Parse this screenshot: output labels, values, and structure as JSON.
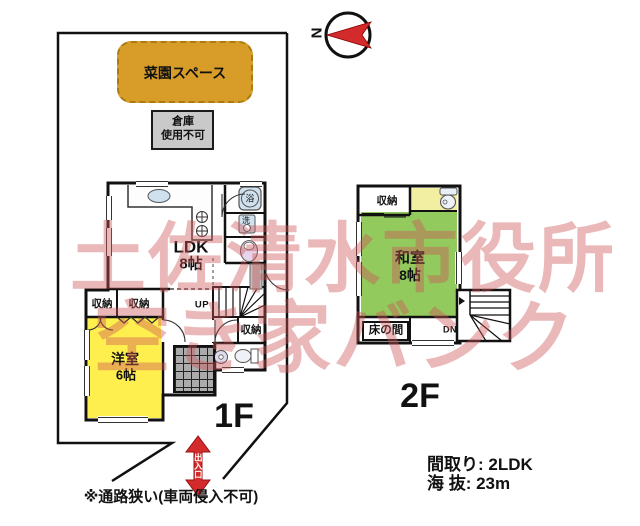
{
  "watermark": {
    "line1": "土佐清水市役所",
    "line2": "空き家バンク"
  },
  "compass": {
    "north_label": "N"
  },
  "site": {
    "garden_label": "菜園スペース",
    "warehouse_line1": "倉庫",
    "warehouse_line2": "使用不可",
    "entrance_label": "出入口",
    "path_note": "※通路狭い(車両侵入不可)"
  },
  "floor1": {
    "label": "1F",
    "ldk_name": "LDK",
    "ldk_size": "8帖",
    "yoshitsu_name": "洋室",
    "yoshitsu_size": "6帖",
    "closets": [
      "収納",
      "収納",
      "収納"
    ],
    "up_label": "UP",
    "bath_label": "浴",
    "wash_label": "洗"
  },
  "floor2": {
    "label": "2F",
    "washitsu_name": "和室",
    "washitsu_size": "8帖",
    "closet": "収納",
    "tokonoma": "床の間",
    "down_label": "DN"
  },
  "info": {
    "layout": "間取り: 2LDK",
    "elevation": "海 抜: 23m"
  },
  "colors": {
    "accent_red": "#d32b2b",
    "garden": "#d79d28",
    "warehouse": "#c9c9c9",
    "room_yellow": "#ffef4e",
    "room_green": "#92ca5e",
    "room_pale_yellow": "#f2efa2",
    "fixture_blue": "#cfe0ef",
    "toilet_pink": "#e6d4ea",
    "tile_gray": "#ababab",
    "watermark": "rgba(205,85,85,0.42)"
  }
}
